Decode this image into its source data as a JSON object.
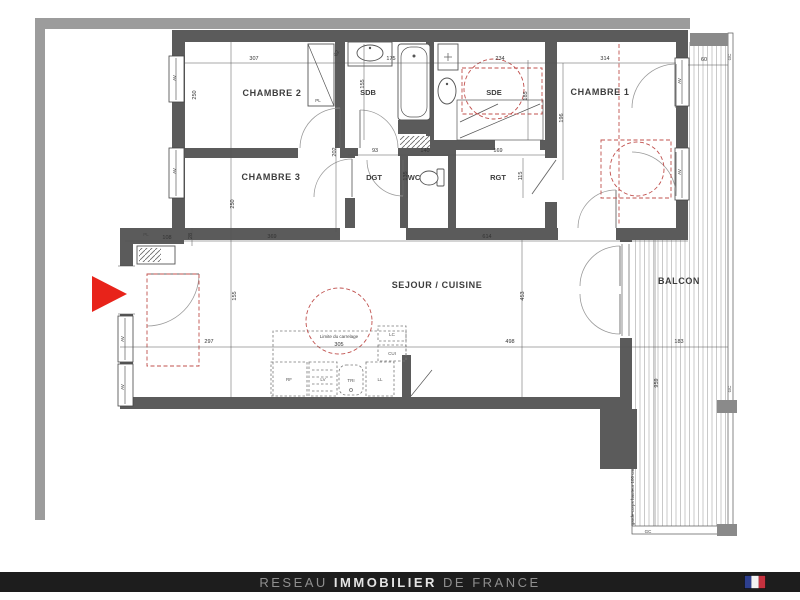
{
  "plan": {
    "rooms": {
      "chambre1": "CHAMBRE 1",
      "chambre2": "CHAMBRE 2",
      "chambre3": "CHAMBRE 3",
      "sdb": "SDB",
      "sde": "SDE",
      "dgt": "DGT",
      "wc": "WC",
      "rgt": "RGT",
      "sejour": "SEJOUR / CUISINE",
      "balcon": "BALCON"
    },
    "kitchen": {
      "rf": "RF",
      "lv": "LV",
      "tri": "TRI",
      "ll": "LL",
      "cui": "CUI",
      "lc": "LC"
    },
    "annotations": {
      "pl": "PL",
      "av": "AV",
      "gc": "GC",
      "limite": "Limite du carrelage",
      "note": "garde-corps hauteur 100 cm"
    },
    "dims": {
      "ch2_w": "307",
      "closet": "62",
      "sdb_h": "155",
      "tub": "175",
      "sde_w": "234",
      "ch1_w": "314",
      "balcon_top": "60",
      "ch2_h": "250",
      "ch3_h": "250",
      "hall_h": "202",
      "dgt_w": "93",
      "wc_w": "140",
      "rgt_w": "169",
      "wc_h": "135",
      "rgt_h": "115",
      "sde_h": "185",
      "ch1_h": "196",
      "pl_w": "108",
      "pl_h": "28",
      "ch3_w": "369",
      "hall_w": "614",
      "entry_h": "155",
      "sejour_h": "453",
      "entry_w": "297",
      "carrelage_w": "305",
      "sejour_w": "498",
      "balcon_w": "183",
      "balcon_h": "959"
    }
  },
  "colors": {
    "arrow_red": "#e8231a",
    "dash_red": "#c0504d",
    "wall_dark": "#5b5b5b",
    "wall_light": "#9c9c9c",
    "footer_bg": "#1d1d1d",
    "flag_blue": "#2d3f8f",
    "flag_white": "#f2f2f2",
    "flag_red": "#c6313e"
  },
  "footer": {
    "brand_prefix": "RESEAU ",
    "brand_main": "IMMOBILIER",
    "brand_suffix": " DE FRANCE"
  }
}
